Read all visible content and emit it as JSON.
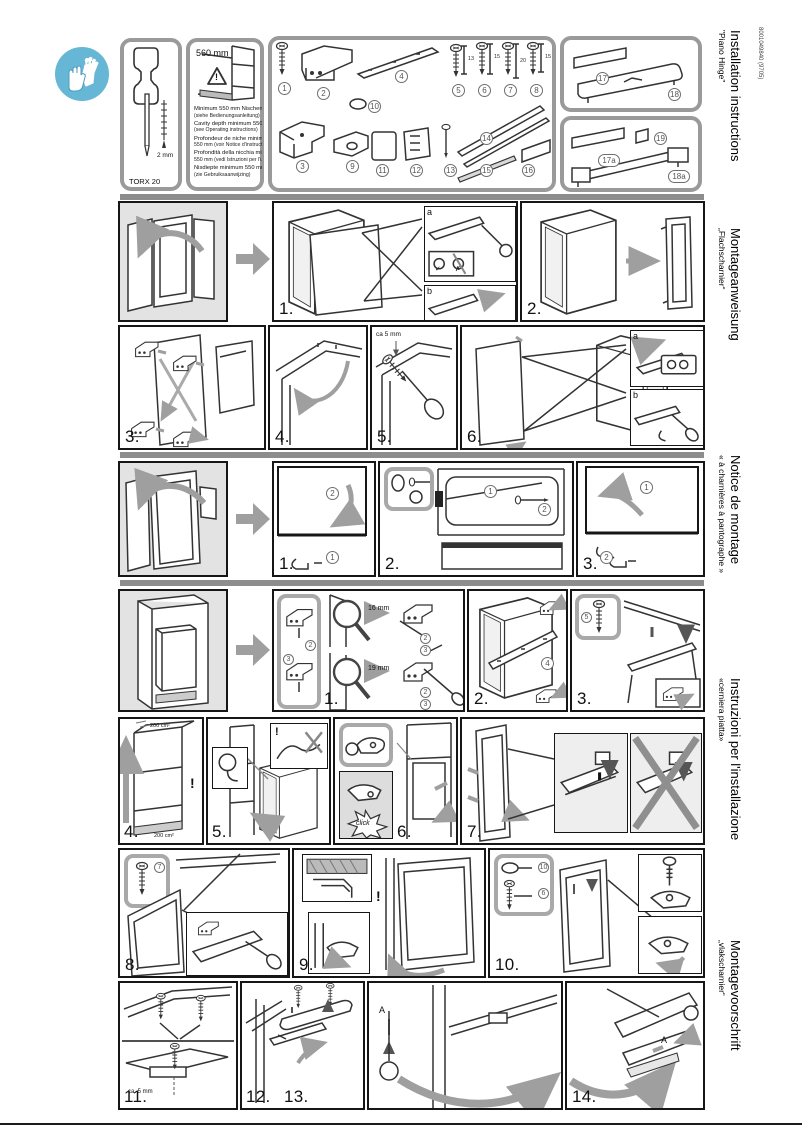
{
  "page": {
    "doc_number": "8001049840 (9705)"
  },
  "side_titles": [
    {
      "title": "Installation instructions",
      "subtitle": "\"Piano Hinge\""
    },
    {
      "title": "Montageanweisung",
      "subtitle": "„Flachscharnier“"
    },
    {
      "title": "Notice de montage",
      "subtitle": "« à charnières à pantographe »"
    },
    {
      "title": "Instruzioni per l'installazione",
      "subtitle": "«cerniera piatta»"
    },
    {
      "title": "Montagevoorschrift",
      "subtitle": "„vlakscharnier“"
    }
  ],
  "header": {
    "tool_label": "TORX 20",
    "bit_size": "2 mm",
    "niche": {
      "dimension": "560 mm",
      "warning_mark": "!",
      "notes": [
        {
          "main": "Minimum 550 mm Nischentiefe",
          "sub": "(siehe Bedienungsanleitung)"
        },
        {
          "main": "Cavity depth minimum 550 mm",
          "sub": "(see Operating instructions)"
        },
        {
          "main": "Profondeur de niche minimum",
          "sub": "550 mm (voir Notice d'instructions)"
        },
        {
          "main": "Profondità della nicchia minimo",
          "sub": "550 mm (vedi Istruzioni per l'uso)"
        },
        {
          "main": "Nisdiepte minimum 550 mm",
          "sub": "(zie Gebruiksaanwijzing)"
        }
      ]
    },
    "parts": {
      "n1": "1",
      "n2": "2",
      "n3": "3",
      "n4": "4",
      "n5": "5",
      "n6": "6",
      "n7": "7",
      "n8": "8",
      "len5": "13",
      "len6": "15",
      "len7": "20",
      "len8": "15",
      "n9": "9",
      "n10": "10",
      "n11": "11",
      "n12": "12",
      "n13": "13",
      "n14": "14",
      "n15": "15",
      "n16": "16",
      "n17": "17",
      "n18": "18",
      "n17a": "17a",
      "n19": "19",
      "n18a": "18a"
    }
  },
  "rows": {
    "a": {
      "step1": "1.",
      "step2": "2.",
      "inset_a": "a",
      "inset_b": "b",
      "check": "✓",
      "cross": "✗"
    },
    "b": {
      "step3": "3.",
      "step4": "4.",
      "step5": "5.",
      "note5": "ca 5 mm",
      "step6": "6.",
      "inset_a": "a",
      "inset_b": "b"
    },
    "c": {
      "step1": "1.",
      "c1_2": "2",
      "c1_1": "1",
      "step2": "2.",
      "c2_1": "1",
      "c2_2": "2",
      "step3": "3.",
      "c3_1": "1",
      "c3_2": "2"
    },
    "d": {
      "step1": "1.",
      "mag_top": "16 mm",
      "mag_bottom": "19 mm",
      "c2": "2",
      "c3": "3",
      "step2": "2.",
      "c4": "4",
      "step3": "3.",
      "c5": "5"
    },
    "e": {
      "step4": "4.",
      "area_top": "200 cm²",
      "area_bottom": "200 cm²",
      "warn": "!",
      "step5": "5.",
      "warn5": "!",
      "step6": "6.",
      "click": "click",
      "step7": "7."
    },
    "f": {
      "step8": "8.",
      "c7": "7",
      "step9": "9.",
      "warn9": "!",
      "step10": "10.",
      "c10": "10",
      "c6": "6"
    },
    "g": {
      "step11": "11.",
      "note11": "ca. 5 mm",
      "step12": "12.",
      "step13": "13.",
      "mark_a": "A",
      "step14": "14.",
      "mark_a14": "A"
    }
  }
}
